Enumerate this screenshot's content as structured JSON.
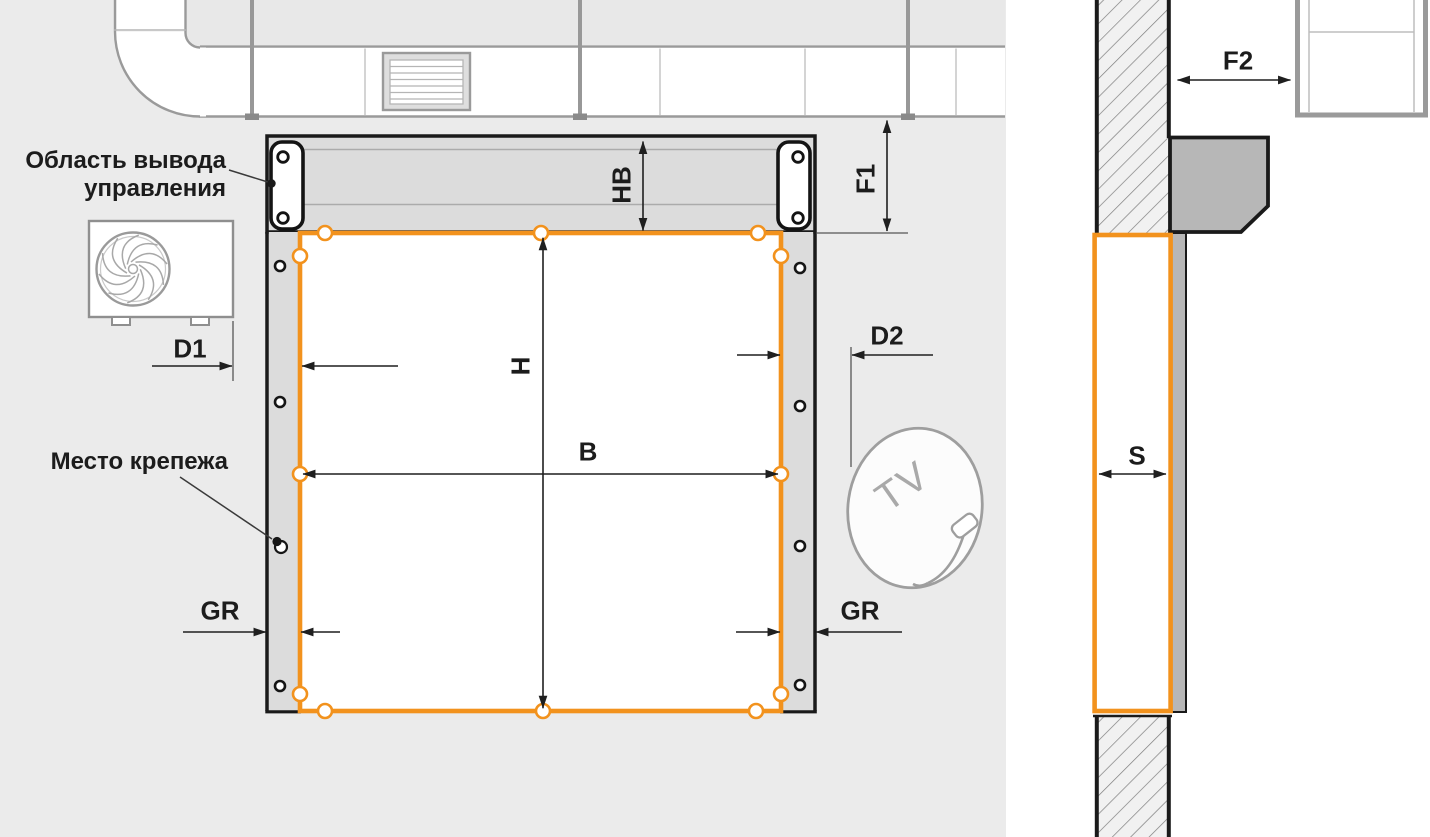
{
  "front_view": {
    "control_area_label": {
      "line1": "Область вывода",
      "line2": "управления"
    },
    "mounting_label": "Место крепежа",
    "dims": {
      "d1": "D1",
      "d2": "D2",
      "gr_left": "GR",
      "gr_right": "GR",
      "hb": "HB",
      "f1": "F1",
      "h": "H",
      "b": "B"
    },
    "dish_text": "TV"
  },
  "section_view": {
    "dims": {
      "f2": "F2",
      "s": "S"
    }
  },
  "colors": {
    "accent_orange": "#F2921D",
    "line_black": "#1A1A1A",
    "panel_bg": "#EBEBEB",
    "metal_gray": "#DCDCDC",
    "housing_gray": "#B7B7B7",
    "duct_gray": "#9A9A9A"
  }
}
